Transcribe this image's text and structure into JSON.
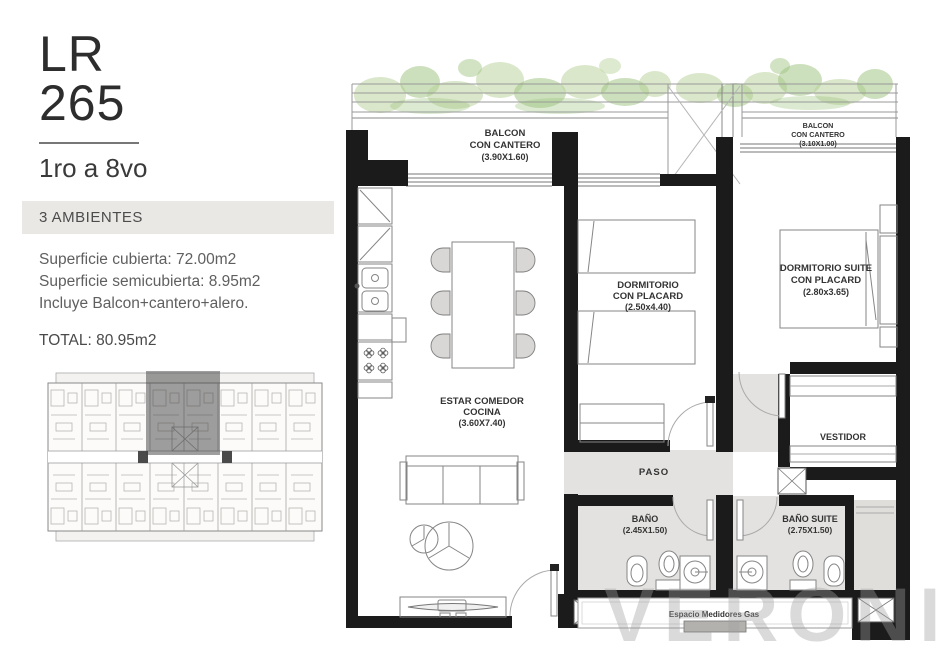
{
  "panel": {
    "code_line1": "LR",
    "code_line2": "265",
    "floors": "1ro a 8vo",
    "ambientes": "3 AMBIENTES",
    "surface_line1": "Superficie cubierta: 72.00m2",
    "surface_line2": "Superficie semicubierta: 8.95m2",
    "surface_line3": "Incluye Balcon+cantero+alero.",
    "total": "TOTAL: 80.95m2"
  },
  "plan": {
    "balcon_left": {
      "l1": "BALCON",
      "l2": "CON CANTERO",
      "l3": "(3.90X1.60)"
    },
    "balcon_right": {
      "l1": "BALCON",
      "l2": "CON CANTERO",
      "l3": "(3.10X1.00)"
    },
    "dormitorio": {
      "l1": "DORMITORIO",
      "l2": "CON PLACARD",
      "l3": "(2.50x4.40)"
    },
    "dormitorio_suite": {
      "l1": "DORMITORIO SUITE",
      "l2": "CON PLACARD",
      "l3": "(2.80x3.65)"
    },
    "estar": {
      "l1": "ESTAR COMEDOR",
      "l2": "COCINA",
      "l3": "(3.60X7.40)"
    },
    "paso": "PASO",
    "vestidor": "VESTIDOR",
    "bano": {
      "l1": "BAÑO",
      "l2": "(2.45X1.50)"
    },
    "bano_suite": {
      "l1": "BAÑO SUITE",
      "l2": "(2.75X1.50)"
    },
    "medidores": "Espacio Medidores Gas"
  },
  "watermark": "VERONIC",
  "colors": {
    "wall": "#1b1b1b",
    "floor": "#e4e2e0",
    "foliage": "#aecb8b",
    "highlight_bar": "#e9e8e5"
  }
}
